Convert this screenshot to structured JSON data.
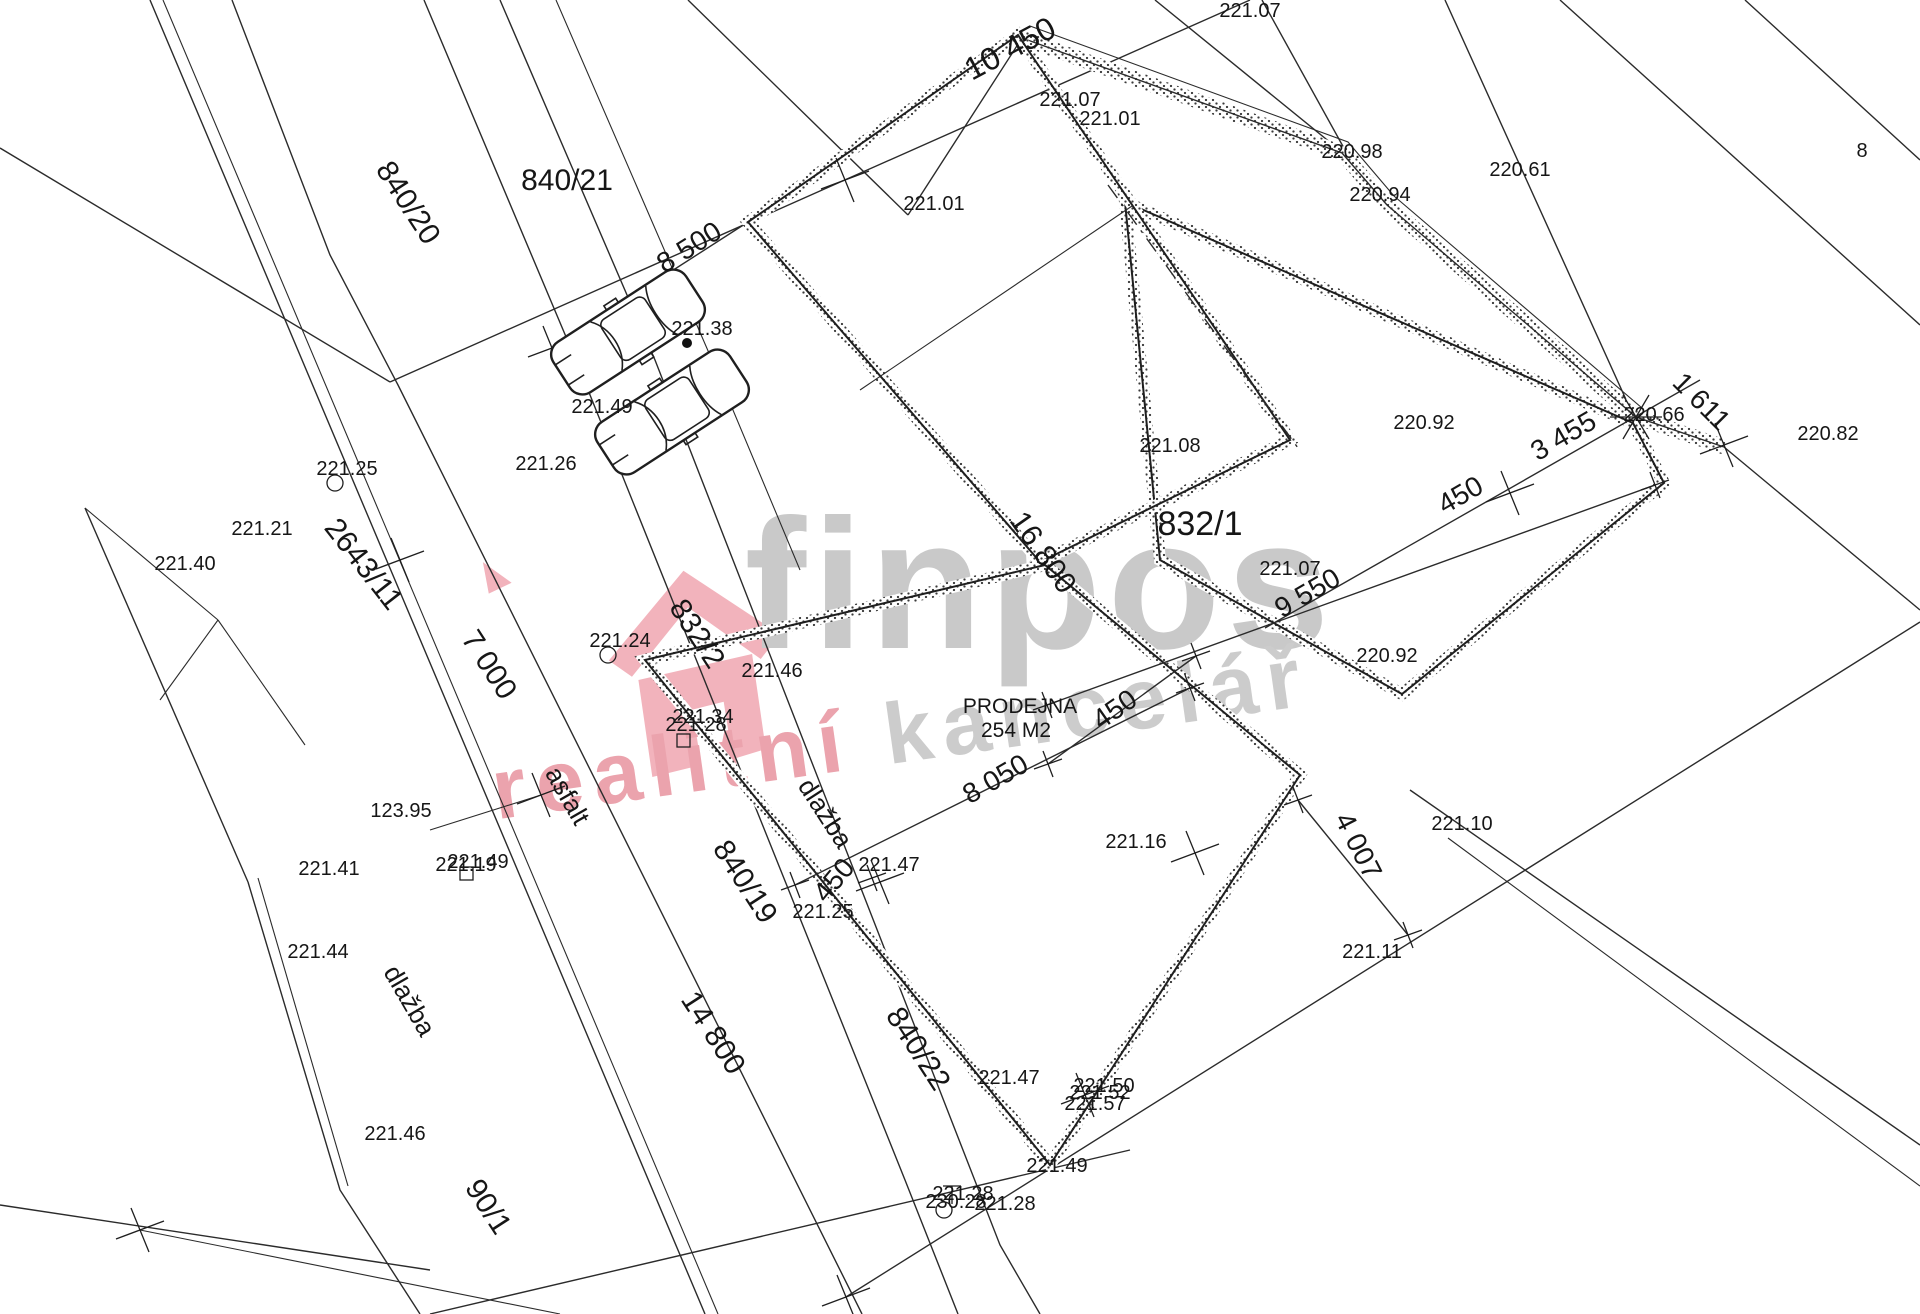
{
  "watermark": {
    "brand": "finpos",
    "tagline_left": "realitní ",
    "tagline_right": "kancelář",
    "brand_color": "#c9c9c9",
    "tagline_gray": "#cccccc",
    "accent_pink": "#eba3ad",
    "house_pink": "#f2b3bc"
  },
  "plan": {
    "labels": {
      "parcels": [
        {
          "text": "840/20",
          "x": 400,
          "y": 208,
          "rot": 57,
          "fs": 30
        },
        {
          "text": "840/21",
          "x": 567,
          "y": 190,
          "rot": 0,
          "fs": 30
        },
        {
          "text": "2643/11",
          "x": 356,
          "y": 570,
          "rot": 52,
          "fs": 30
        },
        {
          "text": "832/2",
          "x": 689,
          "y": 639,
          "rot": 57,
          "fs": 30
        },
        {
          "text": "832/1",
          "x": 1200,
          "y": 535,
          "rot": 0,
          "fs": 34
        },
        {
          "text": "840/19",
          "x": 737,
          "y": 887,
          "rot": 57,
          "fs": 30
        },
        {
          "text": "840/22",
          "x": 910,
          "y": 1054,
          "rot": 57,
          "fs": 30
        },
        {
          "text": "90/1",
          "x": 480,
          "y": 1212,
          "rot": 57,
          "fs": 30
        }
      ],
      "dimensions": [
        {
          "text": "10 450",
          "x": 1015,
          "y": 58,
          "rot": -28,
          "fs": 32
        },
        {
          "text": "8 500",
          "x": 694,
          "y": 255,
          "rot": -32,
          "fs": 28
        },
        {
          "text": "7 000",
          "x": 481,
          "y": 670,
          "rot": 57,
          "fs": 30
        },
        {
          "text": "16 800",
          "x": 1035,
          "y": 558,
          "rot": 55,
          "fs": 30
        },
        {
          "text": "9 550",
          "x": 1312,
          "y": 601,
          "rot": -30,
          "fs": 28
        },
        {
          "text": "450",
          "x": 1465,
          "y": 503,
          "rot": -30,
          "fs": 28
        },
        {
          "text": "3 455",
          "x": 1568,
          "y": 444,
          "rot": -30,
          "fs": 28
        },
        {
          "text": "1 611",
          "x": 1695,
          "y": 408,
          "rot": 45,
          "fs": 28
        },
        {
          "text": "450",
          "x": 1120,
          "y": 717,
          "rot": -35,
          "fs": 28
        },
        {
          "text": "8 050",
          "x": 1000,
          "y": 787,
          "rot": -30,
          "fs": 28
        },
        {
          "text": "450",
          "x": 841,
          "y": 886,
          "rot": -50,
          "fs": 28
        },
        {
          "text": "14 800",
          "x": 705,
          "y": 1038,
          "rot": 57,
          "fs": 30
        },
        {
          "text": "4 007",
          "x": 1350,
          "y": 850,
          "rot": 63,
          "fs": 28
        }
      ],
      "surfaces": [
        {
          "text": "asfalt",
          "x": 560,
          "y": 800,
          "rot": 60,
          "fs": 26
        },
        {
          "text": "dlažba",
          "x": 818,
          "y": 818,
          "rot": 57,
          "fs": 26
        },
        {
          "text": "dlažba",
          "x": 402,
          "y": 1005,
          "rot": 60,
          "fs": 26
        }
      ],
      "building": [
        {
          "text": "PRODEJNA",
          "x": 1020,
          "y": 713,
          "rot": 0,
          "fs": 21
        },
        {
          "text": "254 M2",
          "x": 1016,
          "y": 737,
          "rot": 0,
          "fs": 21
        }
      ],
      "elevations": [
        {
          "text": "221.07",
          "x": 1250,
          "y": 17
        },
        {
          "text": "221.07",
          "x": 1070,
          "y": 106
        },
        {
          "text": "221.01",
          "x": 1110,
          "y": 125
        },
        {
          "text": "221.01",
          "x": 934,
          "y": 210
        },
        {
          "text": "220.98",
          "x": 1352,
          "y": 158
        },
        {
          "text": "220.94",
          "x": 1380,
          "y": 201
        },
        {
          "text": "220.61",
          "x": 1520,
          "y": 176
        },
        {
          "text": "8",
          "x": 1862,
          "y": 157
        },
        {
          "text": "221.38",
          "x": 702,
          "y": 335
        },
        {
          "text": "221.49",
          "x": 602,
          "y": 413
        },
        {
          "text": "221.26",
          "x": 546,
          "y": 470
        },
        {
          "text": "221.25",
          "x": 347,
          "y": 475
        },
        {
          "text": "221.21",
          "x": 262,
          "y": 535
        },
        {
          "text": "221.40",
          "x": 185,
          "y": 570
        },
        {
          "text": "221.24",
          "x": 620,
          "y": 647
        },
        {
          "text": "221.46",
          "x": 772,
          "y": 677
        },
        {
          "text": "221.34",
          "x": 703,
          "y": 723
        },
        {
          "text": "221.28",
          "x": 696,
          "y": 731
        },
        {
          "text": "221.08",
          "x": 1170,
          "y": 452
        },
        {
          "text": "220.66",
          "x": 1654,
          "y": 421
        },
        {
          "text": "220.82",
          "x": 1828,
          "y": 440
        },
        {
          "text": "220.92",
          "x": 1424,
          "y": 429
        },
        {
          "text": "220.92",
          "x": 1387,
          "y": 662
        },
        {
          "text": "221.07",
          "x": 1290,
          "y": 575
        },
        {
          "text": "221.10",
          "x": 1462,
          "y": 830
        },
        {
          "text": "221.11",
          "x": 1372,
          "y": 958
        },
        {
          "text": "221.16",
          "x": 1136,
          "y": 848
        },
        {
          "text": "221.47",
          "x": 889,
          "y": 871
        },
        {
          "text": "221.25",
          "x": 823,
          "y": 918
        },
        {
          "text": "123.95",
          "x": 401,
          "y": 817
        },
        {
          "text": "221.41",
          "x": 329,
          "y": 875
        },
        {
          "text": "221.19",
          "x": 466,
          "y": 871
        },
        {
          "text": "221.49",
          "x": 478,
          "y": 868
        },
        {
          "text": "221.44",
          "x": 318,
          "y": 958
        },
        {
          "text": "221.46",
          "x": 395,
          "y": 1140
        },
        {
          "text": "221.47",
          "x": 1009,
          "y": 1084
        },
        {
          "text": "221.50",
          "x": 1104,
          "y": 1092
        },
        {
          "text": "221.52",
          "x": 1100,
          "y": 1099
        },
        {
          "text": "221.57",
          "x": 1095,
          "y": 1110
        },
        {
          "text": "221.49",
          "x": 1057,
          "y": 1172
        },
        {
          "text": "221.28",
          "x": 963,
          "y": 1200
        },
        {
          "text": "230.28",
          "x": 956,
          "y": 1208
        },
        {
          "text": "221.28",
          "x": 1005,
          "y": 1210
        }
      ]
    }
  }
}
